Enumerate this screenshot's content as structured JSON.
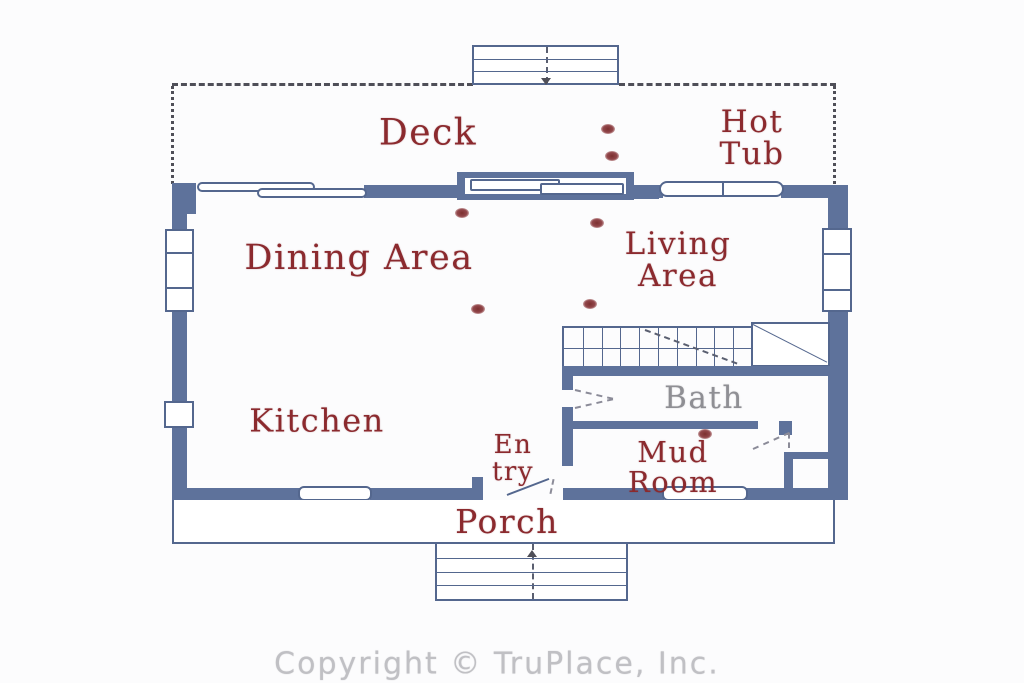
{
  "plan_type": "first-floor floor plan",
  "colors": {
    "wall": "#5e729b",
    "outline": "#54678e",
    "boundary": "#4f4f58",
    "room_label": "#8b2a2e",
    "bath_label": "#8f8f94",
    "dot": "#7c3030",
    "copyright": "#c0c0c4",
    "background": "#fcfcfd"
  },
  "labels": {
    "deck": "Deck",
    "hot_tub": "Hot\nTub",
    "dining": "Dining Area",
    "living": "Living\nArea",
    "kitchen": "Kitchen",
    "entry": "En\ntry",
    "bath": "Bath",
    "mud_room": "Mud\nRoom",
    "porch": "Porch"
  },
  "watermark": "Copyright © TruPlace, Inc.",
  "light_dots": [
    {
      "x": 608,
      "y": 129
    },
    {
      "x": 612,
      "y": 156
    },
    {
      "x": 462,
      "y": 213
    },
    {
      "x": 597,
      "y": 223
    },
    {
      "x": 478,
      "y": 309
    },
    {
      "x": 590,
      "y": 304
    },
    {
      "x": 705,
      "y": 434
    }
  ],
  "stairs": {
    "deck_treads": 2,
    "interior_treads": 9,
    "porch_treads": 3
  }
}
